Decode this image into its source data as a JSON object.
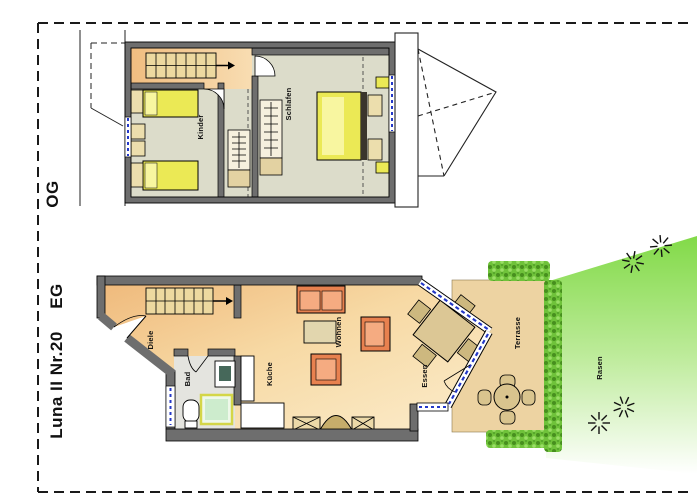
{
  "plan": {
    "project": "Luna II Nr.20",
    "floors": {
      "og": "OG",
      "eg": "EG"
    },
    "rooms": {
      "kinder": "Kinder",
      "schlafen": "Schlafen",
      "diele": "Diele",
      "bad": "Bad",
      "kueche": "Küche",
      "wohnen": "Wohnen",
      "essen": "Essen",
      "terrasse": "Terrasse",
      "rasen": "Rasen"
    },
    "colors": {
      "wall_gray": "#6e6e6e",
      "floor_og": "#dcdcca",
      "floor_eg_start": "#efb97b",
      "floor_eg_end": "#fbeccb",
      "bed_yellow": "#ebe955",
      "sofa_orange": "#ef9468",
      "wood_tan": "#d9c48e",
      "lawn_green": "#82da48",
      "hedge_green": "#6fc23a",
      "window_blue": "#2438c8",
      "stair_tan": "#edd9a0"
    }
  }
}
